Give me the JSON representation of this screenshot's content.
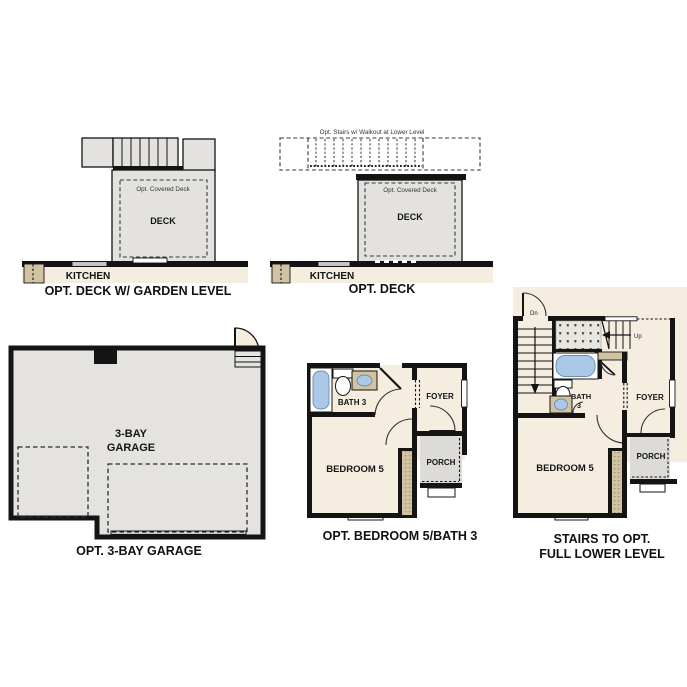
{
  "colors": {
    "wall": "#141414",
    "deck_fill": "#e3e2df",
    "garage_fill": "#e4e3e0",
    "porch_fill": "#dcdbd8",
    "interior_fill": "#f5eee0",
    "tan_accent": "#d2c4a2",
    "tub_blue": "#abc8e6",
    "dotted_area_fill": "#e9e6df",
    "step_fill": "#e9e8e5"
  },
  "panels": {
    "deck_garden": {
      "caption": "OPT. DECK W/ GARDEN LEVEL",
      "covered_deck": "Opt. Covered Deck",
      "deck": "DECK",
      "kitchen": "KITCHEN"
    },
    "deck_only": {
      "caption": "OPT. DECK",
      "stairs_note": "Opt. Stairs w/ Walkout at Lower Level",
      "covered_deck": "Opt. Covered Deck",
      "deck": "DECK",
      "kitchen": "KITCHEN"
    },
    "garage": {
      "caption": "OPT. 3-BAY GARAGE",
      "label_line1": "3-BAY",
      "label_line2": "GARAGE"
    },
    "bedroom5": {
      "caption": "OPT. BEDROOM 5/BATH 3",
      "bath": "BATH 3",
      "foyer": "FOYER",
      "bedroom": "BEDROOM 5",
      "porch": "PORCH"
    },
    "stairs_lower": {
      "caption_line1": "STAIRS TO OPT.",
      "caption_line2": "FULL LOWER LEVEL",
      "dn": "Dn",
      "up": "Up",
      "bath_line1": "BATH",
      "bath_line2": "3",
      "foyer": "FOYER",
      "bedroom": "BEDROOM 5",
      "porch": "PORCH"
    }
  }
}
